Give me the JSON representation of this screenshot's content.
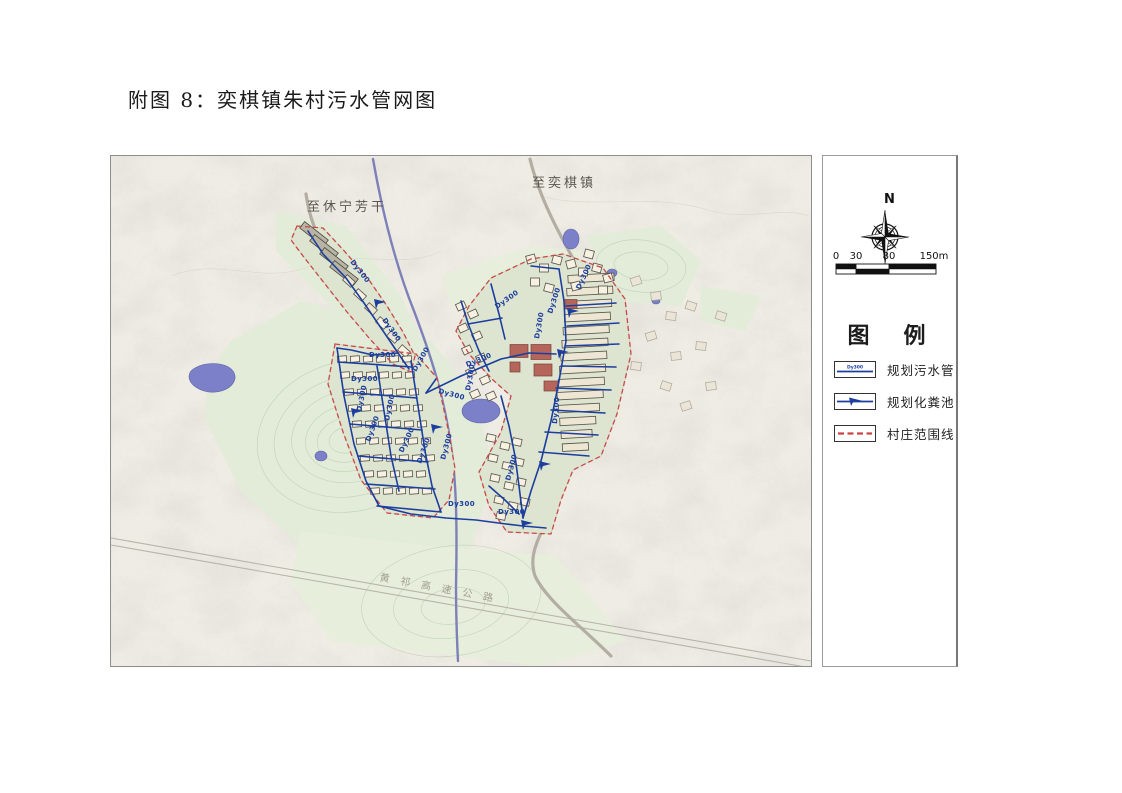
{
  "page": {
    "title": "附图 8：奕棋镇朱村污水管网图"
  },
  "map": {
    "labels": {
      "to_yiqi": "至奕棋镇",
      "to_xiuning": "至休宁芳干",
      "expressway": "黄祁高速公路"
    },
    "pipe_label_text": "Dy300",
    "pipe_labels": [
      {
        "x": 239,
        "y": 106,
        "r": 52
      },
      {
        "x": 271,
        "y": 164,
        "r": 55
      },
      {
        "x": 258,
        "y": 201,
        "r": 0
      },
      {
        "x": 240,
        "y": 225,
        "r": 0
      },
      {
        "x": 250,
        "y": 256,
        "r": -78
      },
      {
        "x": 259,
        "y": 286,
        "r": -70
      },
      {
        "x": 278,
        "y": 265,
        "r": -78
      },
      {
        "x": 292,
        "y": 297,
        "r": -65
      },
      {
        "x": 310,
        "y": 308,
        "r": -70
      },
      {
        "x": 334,
        "y": 304,
        "r": -75
      },
      {
        "x": 305,
        "y": 216,
        "r": -60
      },
      {
        "x": 356,
        "y": 211,
        "r": -22
      },
      {
        "x": 327,
        "y": 237,
        "r": 15
      },
      {
        "x": 337,
        "y": 350,
        "r": 0
      },
      {
        "x": 387,
        "y": 358,
        "r": 0
      },
      {
        "x": 428,
        "y": 183,
        "r": -80
      },
      {
        "x": 441,
        "y": 158,
        "r": -72
      },
      {
        "x": 446,
        "y": 268,
        "r": -85
      },
      {
        "x": 386,
        "y": 153,
        "r": -35
      },
      {
        "x": 359,
        "y": 235,
        "r": -80
      },
      {
        "x": 399,
        "y": 325,
        "r": -75
      },
      {
        "x": 469,
        "y": 134,
        "r": -65
      }
    ]
  },
  "legend": {
    "compass_label": "N",
    "scale": {
      "ticks": [
        "0",
        "30",
        "80",
        "150m"
      ]
    },
    "title": "图　例",
    "items": [
      {
        "symbol": "sewage-pipe",
        "label": "规划污水管"
      },
      {
        "symbol": "septic-tank",
        "label": "规划化粪池"
      },
      {
        "symbol": "village-boundary",
        "label": "村庄范围线"
      }
    ]
  },
  "colors": {
    "pipe": "#1c3e9e",
    "river": "#7d81b8",
    "pond": "#7b80c8",
    "boundary": "#c84848",
    "road": "#b3ada2",
    "map_bg": "#efece3",
    "green": "#e3ecd9",
    "red_building": "#b5655a"
  }
}
